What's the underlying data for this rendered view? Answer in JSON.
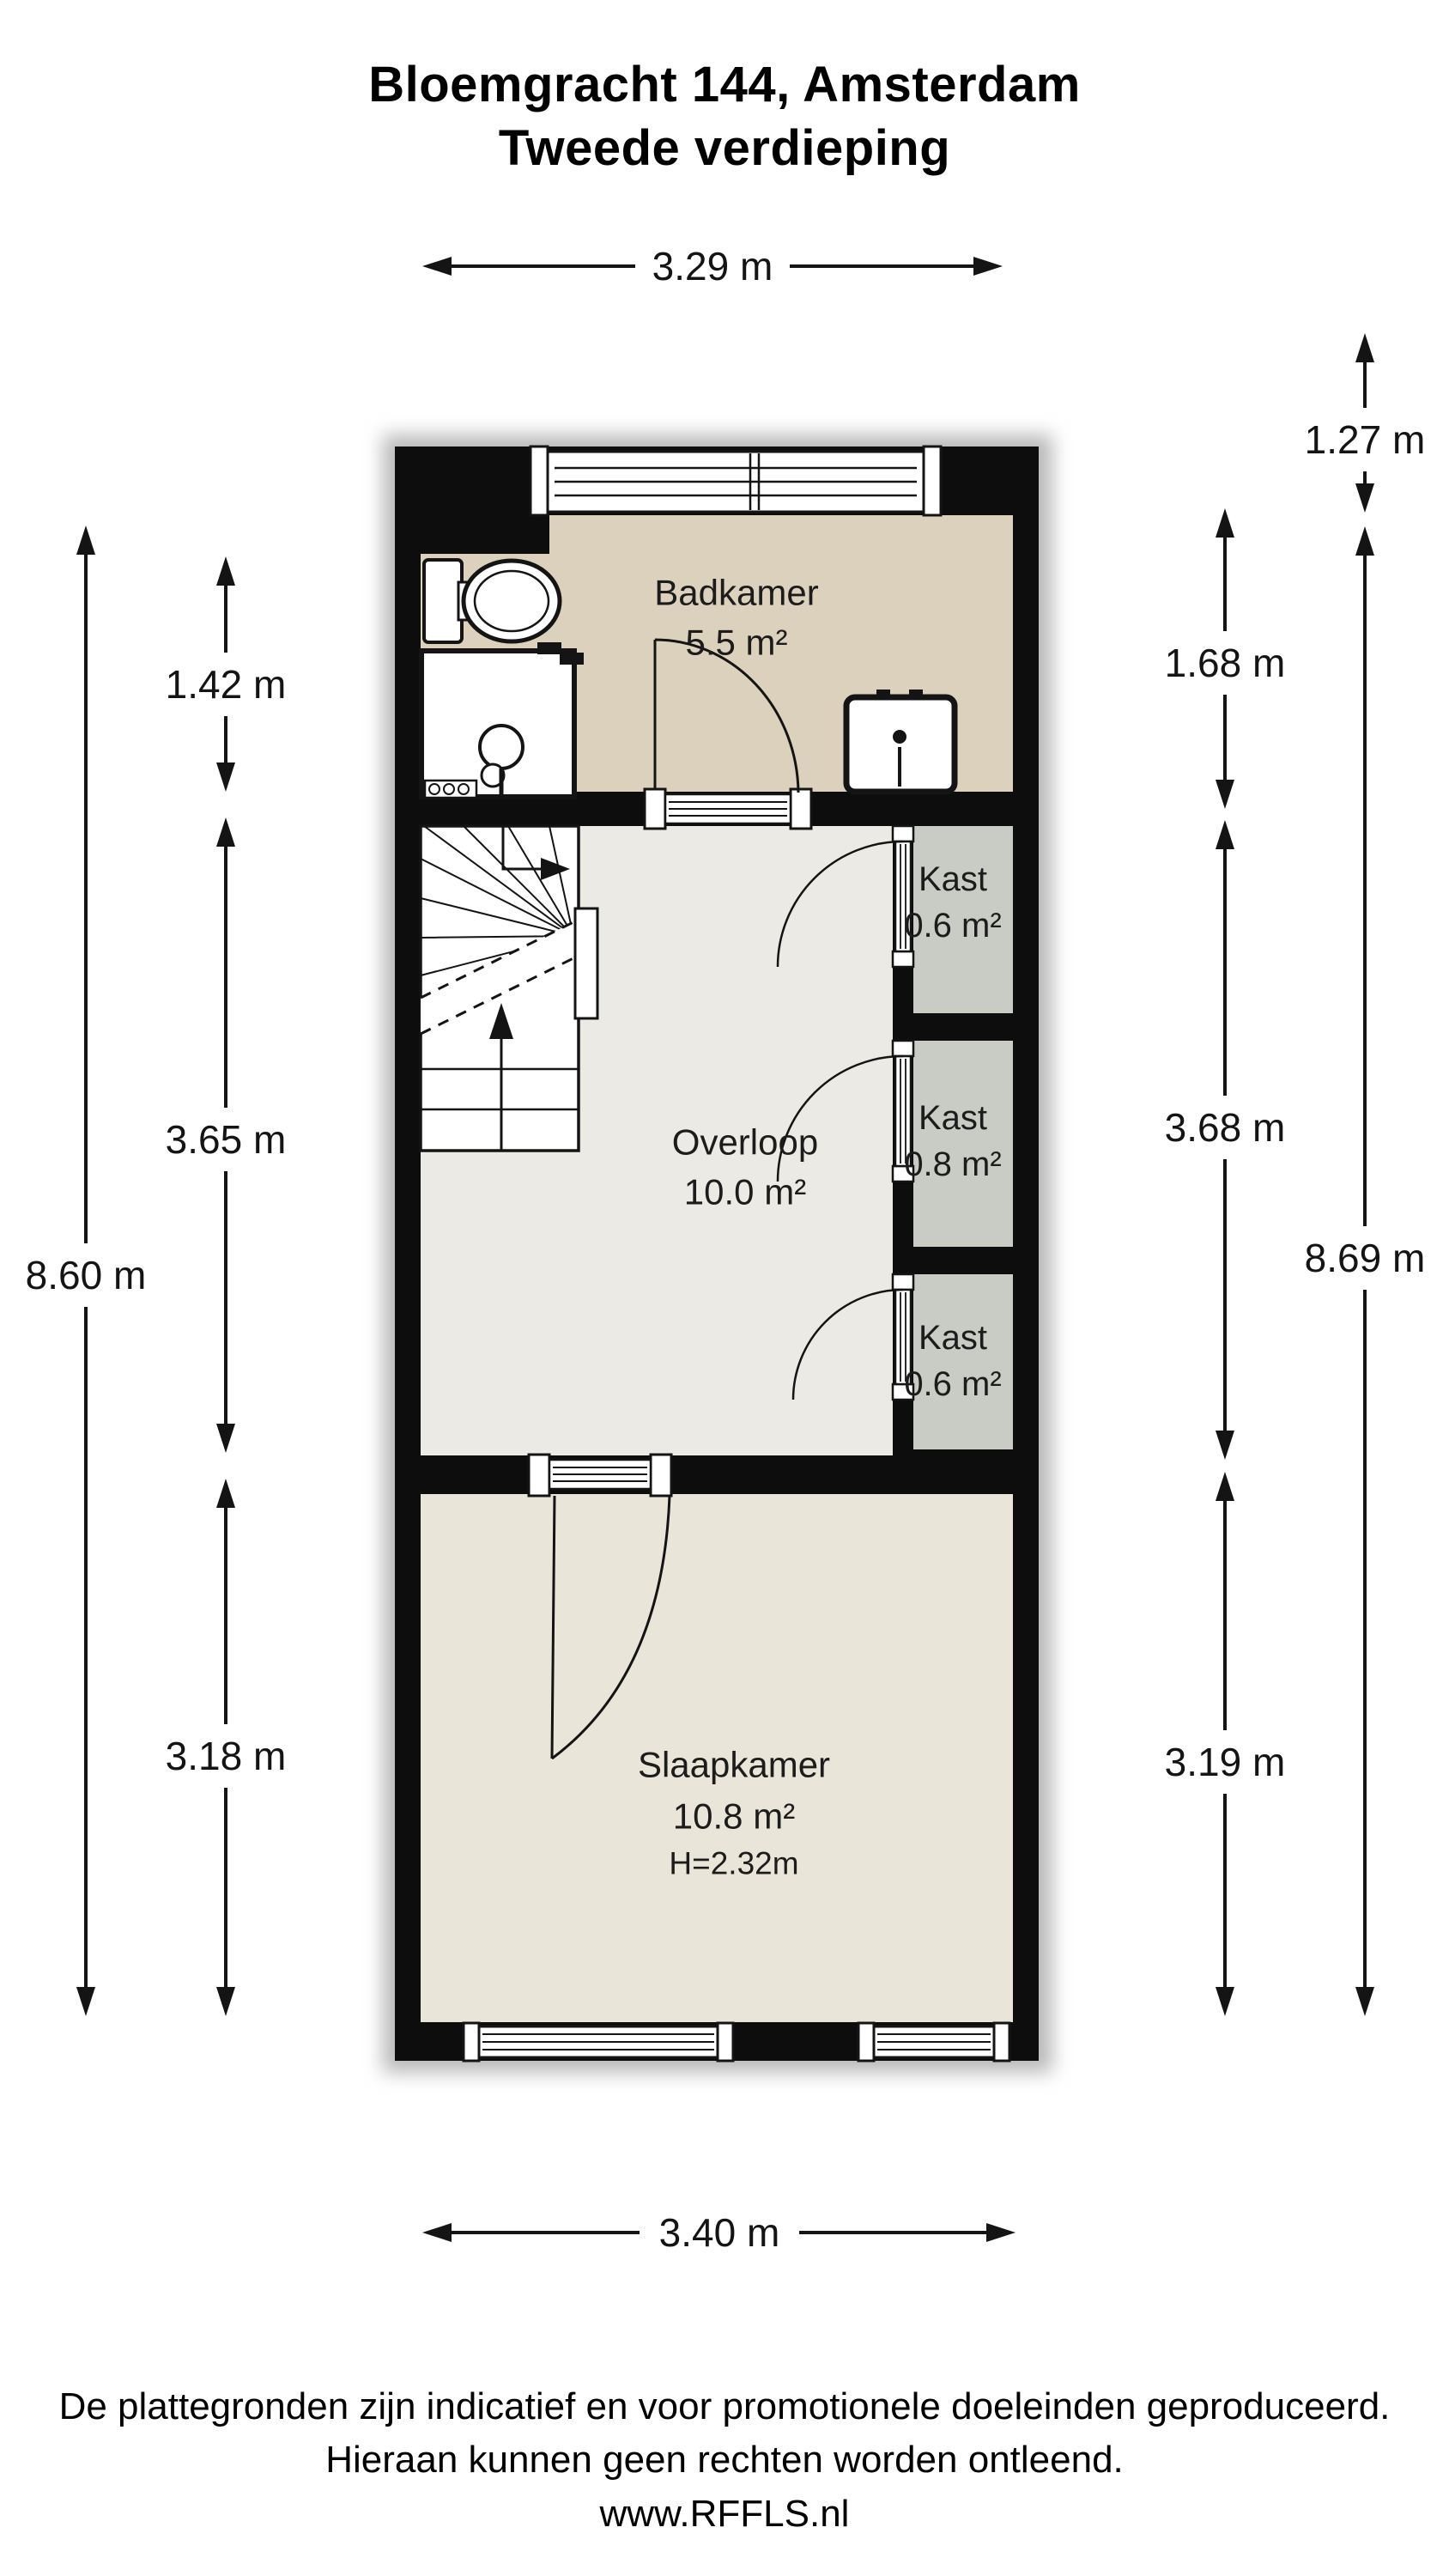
{
  "title": {
    "line1": "Bloemgracht 144, Amsterdam",
    "line2": "Tweede verdieping"
  },
  "floorplan": {
    "rooms": {
      "badkamer": {
        "name": "Badkamer",
        "area": "5.5 m²"
      },
      "overloop": {
        "name": "Overloop",
        "area": "10.0 m²"
      },
      "kast_boven": {
        "name": "Kast",
        "area": "0.6 m²"
      },
      "kast_midden": {
        "name": "Kast",
        "area": "0.8 m²"
      },
      "kast_onder": {
        "name": "Kast",
        "area": "0.6 m²"
      },
      "slaapkamer": {
        "name": "Slaapkamer",
        "area": "10.8 m²",
        "ceiling_height": "H=2.32m"
      }
    },
    "dimensions": {
      "top_width": "3.29 m",
      "bottom_width": "3.40 m",
      "left_total": "8.60 m",
      "left_badkamer": "1.42 m",
      "left_overloop": "3.65 m",
      "left_slaapkamer": "3.18 m",
      "right_roof": "1.27 m",
      "right_badkamer": "1.68 m",
      "right_overloop": "3.68 m",
      "right_total": "8.69 m",
      "right_slaapkamer": "3.19 m"
    },
    "colors": {
      "wall": "#0d0d0d",
      "badkamer_floor": "#dcd1bd",
      "overloop_floor": "#ebeae4",
      "kast_floor": "#c9ccc4",
      "slaapkamer_floor": "#e9e5d9",
      "fixture_fill": "#ffffff",
      "line": "#141414"
    }
  },
  "footer": {
    "line1": "De plattegronden zijn indicatief en voor promotionele doeleinden geproduceerd.",
    "line2": "Hieraan kunnen geen rechten worden ontleend.",
    "line3": "www.RFFLS.nl"
  }
}
